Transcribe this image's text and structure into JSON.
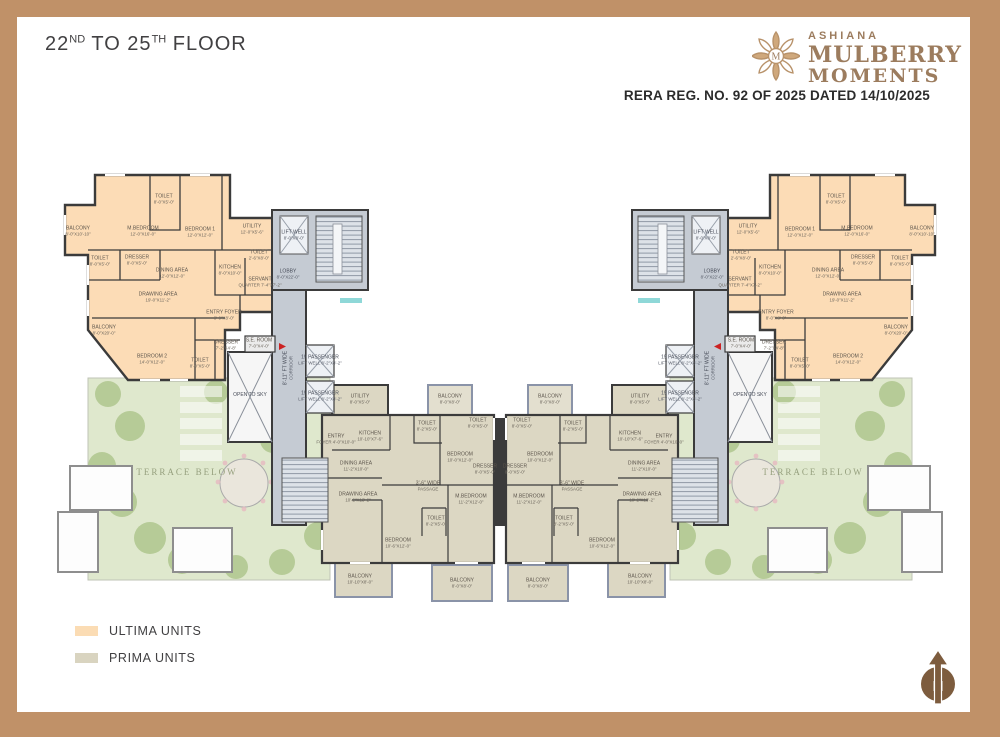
{
  "header": {
    "floor_prefix": "22",
    "floor_sup1": "ND",
    "floor_mid": " TO 25",
    "floor_sup2": "TH",
    "floor_suffix": " FLOOR"
  },
  "brand": {
    "name": "ASHIANA",
    "line1": "MULBERRY",
    "line2": "MOMENTS",
    "color": "#9c7c5e"
  },
  "rera_line": "RERA REG. NO. 92 OF 2025 DATED 14/10/2025",
  "legend": {
    "items": [
      {
        "label": "ULTIMA UNITS",
        "color": "#fbdcb4"
      },
      {
        "label": "PRIMA UNITS",
        "color": "#d9d4c0"
      }
    ]
  },
  "compass": {
    "letter": "N",
    "note": "Not to scale"
  },
  "plan": {
    "terrace": {
      "label": "TERRACE BELOW",
      "x": 157,
      "y": 332
    },
    "colors": {
      "ultima": "#fcdcb6",
      "prima": "#dcd7c3",
      "core": "#c5cbd3",
      "terrace_green": "#cddbb0",
      "walls": "#3b3b3b",
      "frame": "#c09168"
    },
    "rooms": {
      "ultima_wing": [
        {
          "label": "BALCONY",
          "dim": "8'-0\"X10'-10\"",
          "x": 48,
          "y": 92
        },
        {
          "label": "M.BEDROOM",
          "dim": "12'-0\"X16'-0\"",
          "x": 113,
          "y": 92
        },
        {
          "label": "TOILET",
          "dim": "8'-0\"X5'-0\"",
          "x": 134,
          "y": 60
        },
        {
          "label": "BEDROOM 1",
          "dim": "12'-0\"X12'-0\"",
          "x": 170,
          "y": 93
        },
        {
          "label": "UTILITY",
          "dim": "12'-0\"X5'-6\"",
          "x": 222,
          "y": 90
        },
        {
          "label": "TOILET",
          "dim": "8'-0\"X5'-0\"",
          "x": 70,
          "y": 122
        },
        {
          "label": "DRESSER",
          "dim": "8'-0\"X5'-0\"",
          "x": 107,
          "y": 121
        },
        {
          "label": "DINING AREA",
          "dim": "12'-0\"X12'-0\"",
          "x": 142,
          "y": 134
        },
        {
          "label": "KITCHEN",
          "dim": "8'-0\"X10'-0\"",
          "x": 200,
          "y": 131
        },
        {
          "label": "TOILET",
          "dim": "2'-6\"X8'-0\"",
          "x": 229,
          "y": 116
        },
        {
          "label": "SERVANT",
          "dim": "QUARTER 7'-4\"X7'-2\"",
          "x": 230,
          "y": 143
        },
        {
          "label": "DRAWING AREA",
          "dim": "19'-0\"X11'-2\"",
          "x": 128,
          "y": 158
        },
        {
          "label": "ENTRY FOYER",
          "dim": "8'-0\"X8'-0\"",
          "x": 194,
          "y": 176
        },
        {
          "label": "BALCONY",
          "dim": "8'-0\"X20'-0\"",
          "x": 74,
          "y": 191
        },
        {
          "label": "BEDROOM 2",
          "dim": "14'-0\"X12'-0\"",
          "x": 122,
          "y": 220
        },
        {
          "label": "DRESSER",
          "dim": "7'-2\"X4'-8\"",
          "x": 196,
          "y": 206
        },
        {
          "label": "TOILET",
          "dim": "8'-0\"X5'-0\"",
          "x": 170,
          "y": 224
        },
        {
          "label": "S.E. ROOM",
          "dim": "7'-0\"X4'-0\"",
          "x": 229,
          "y": 204
        }
      ],
      "core": [
        {
          "label": "LIFT WELL",
          "dim": "8'-0\"X8'-0\"",
          "x": 264,
          "y": 96
        },
        {
          "label": "LOBBY",
          "dim": "8'-0\"X22'-0\"",
          "x": 258,
          "y": 135
        },
        {
          "label": "OPEN TO SKY",
          "x": 220,
          "y": 256
        },
        {
          "label": "8'-11\" FT WIDE",
          "dim": "CORRIDOR",
          "x": 259,
          "y": 228,
          "rot": 1
        },
        {
          "label": "19 PASSENGER",
          "dim": "LIFT WELL 8'-2\"X8'-2\"",
          "x": 290,
          "y": 221
        },
        {
          "label": "19 PASSENGER",
          "dim": "LIFT WELL 8'-2\"X8'-2\"",
          "x": 290,
          "y": 257
        }
      ],
      "prima_unit": [
        {
          "label": "UTILITY",
          "dim": "8'-0\"X5'-0\"",
          "x": 330,
          "y": 260
        },
        {
          "label": "BALCONY",
          "dim": "8'-0\"X8'-0\"",
          "x": 420,
          "y": 260
        },
        {
          "label": "ENTRY",
          "dim": "FOYER 4'-0\"X10'-0\"",
          "x": 306,
          "y": 300
        },
        {
          "label": "KITCHEN",
          "dim": "10'-10\"X7'-6\"",
          "x": 340,
          "y": 297
        },
        {
          "label": "TOILET",
          "dim": "8'-2\"X5'-0\"",
          "x": 397,
          "y": 287
        },
        {
          "label": "TOILET",
          "dim": "8'-0\"X5'-0\"",
          "x": 448,
          "y": 284
        },
        {
          "label": "BEDROOM",
          "dim": "10'-0\"X12'-0\"",
          "x": 430,
          "y": 318
        },
        {
          "label": "DRESSER",
          "dim": "8'-0\"X5'-0\"",
          "x": 455,
          "y": 330
        },
        {
          "label": "DINING AREA",
          "dim": "11'-2\"X10'-0\"",
          "x": 326,
          "y": 327
        },
        {
          "label": "3'-6\" WIDE",
          "dim": "PASSAGE",
          "x": 398,
          "y": 347
        },
        {
          "label": "DRAWING AREA",
          "dim": "10'-2\"X13'-2\"",
          "x": 328,
          "y": 358
        },
        {
          "label": "M.BEDROOM",
          "dim": "11'-2\"X12'-0\"",
          "x": 441,
          "y": 360
        },
        {
          "label": "BEDROOM",
          "dim": "10'-6\"X12'-0\"",
          "x": 368,
          "y": 404
        },
        {
          "label": "TOILET",
          "dim": "8'-2\"X5'-0\"",
          "x": 406,
          "y": 382
        },
        {
          "label": "BALCONY",
          "dim": "10'-10\"X8'-0\"",
          "x": 330,
          "y": 440
        },
        {
          "label": "BALCONY",
          "dim": "8'-0\"X8'-0\"",
          "x": 432,
          "y": 444
        }
      ]
    }
  }
}
